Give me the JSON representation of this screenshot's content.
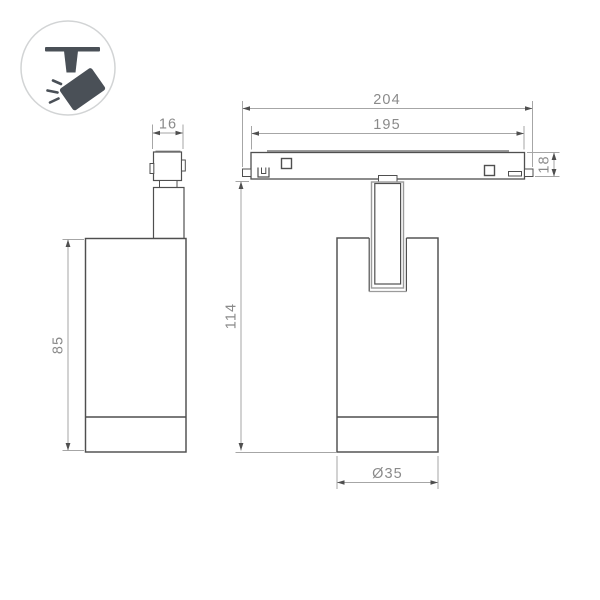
{
  "drawing_title": "magnetic-track-spotlight-dimension-drawing",
  "icon_badge": {
    "name": "spotlight-on-track"
  },
  "dimensions": {
    "side_adapter_width": "16",
    "side_body_height": "85",
    "track_length_overall": "204",
    "track_length_rail": "195",
    "track_height": "18",
    "fixture_height": "114",
    "body_diameter": "Ø35"
  },
  "colors": {
    "object_line": "#4f4f4f",
    "detail_gray": "#9b9b9b",
    "dimension_line": "#a6a6a6",
    "dimension_text": "#8a8a8a",
    "icon_fill": "#4a5057",
    "icon_circle_border": "#d2d4d5"
  }
}
